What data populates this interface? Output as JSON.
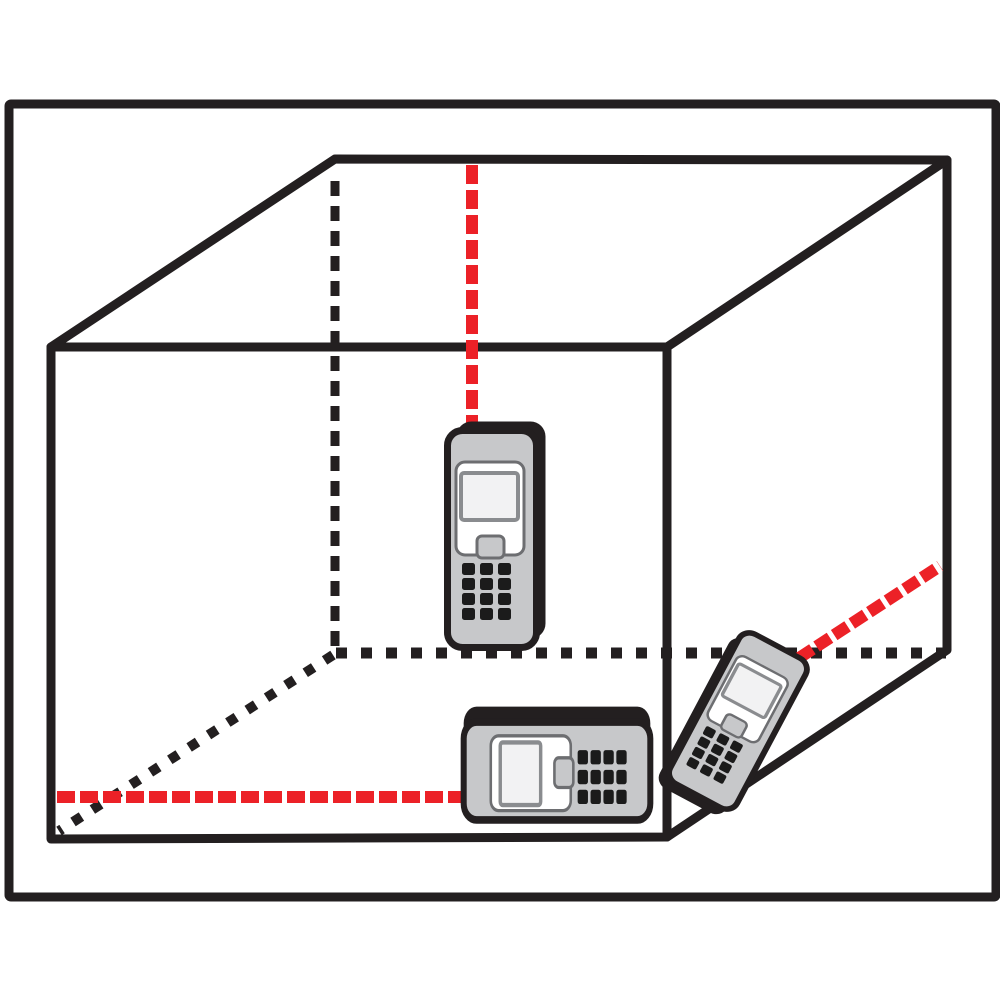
{
  "colors": {
    "background": "#FFFFFF",
    "line": "#231F20",
    "laser_red": "#EC2127",
    "device_body": "#C7C8CA",
    "panel_fill": "#FFFFFF",
    "panel_border": "#6D6E71",
    "screen_fill": "#F2F2F3",
    "screen_border": "#8A8C8F",
    "key": "#1B1B1B"
  },
  "diagram": {
    "frame": {
      "x": 9,
      "y": 104,
      "w": 987,
      "h": 793,
      "stroke_w": 9
    },
    "room": {
      "stroke_w": 9,
      "silhouette_path": "M 51 839 L 51 347 L 335 159 L 947 160 L 947 650 L 667 837 Z",
      "interior_path": "M 51 347 L 667 347 L 947 160 M 667 347 L 667 837",
      "hidden_edges": [
        {
          "name": "hidden-edge-back-left-vertical",
          "x1": 335,
          "y1": 181,
          "x2": 335,
          "y2": 651,
          "w": 9,
          "dash": "15 10"
        },
        {
          "name": "hidden-edge-back-bottom",
          "x1": 336,
          "y1": 653,
          "x2": 946,
          "y2": 653,
          "w": 11,
          "dash": "11 14"
        },
        {
          "name": "hidden-edge-floor-left",
          "x1": 333,
          "y1": 655,
          "x2": 59,
          "y2": 831,
          "w": 10,
          "dash": "10 13"
        }
      ]
    },
    "lasers": [
      {
        "name": "laser-beam-height",
        "x1": 472,
        "y1": 165,
        "x2": 472,
        "y2": 428,
        "w": 12,
        "dash": "19 6"
      },
      {
        "name": "laser-beam-length",
        "x1": 57,
        "y1": 797,
        "x2": 463,
        "y2": 797,
        "w": 12,
        "dash": "18 5"
      },
      {
        "name": "laser-beam-width",
        "x1": 799,
        "y1": 658,
        "x2": 940,
        "y2": 566,
        "w": 12,
        "dash": "16 5"
      }
    ],
    "device_design": {
      "body": {
        "x": -44.5,
        "y": -108.5,
        "w": 89,
        "h": 217,
        "rx": 15,
        "stroke_w": 7
      },
      "panel": {
        "x": -36,
        "y": -77,
        "w": 68,
        "h": 93,
        "rx": 9,
        "stroke_w": 3
      },
      "screen": {
        "x": -31,
        "y": -66,
        "w": 57,
        "h": 47,
        "rx": 3,
        "stroke_w": 4
      },
      "notch": {
        "x": -15,
        "y": -3,
        "w": 27,
        "h": 22,
        "rx": 5,
        "stroke_w": 3
      },
      "keys": {
        "cols": [
          -30,
          -12,
          6
        ],
        "rows": [
          24,
          39,
          54,
          69
        ],
        "w": 13,
        "h": 12,
        "rx": 2.5
      }
    },
    "devices": [
      {
        "name": "laser-meter-vertical",
        "transform": "translate(492,539)",
        "depth": [
          9,
          -9
        ]
      },
      {
        "name": "laser-meter-horizontal",
        "transform": "translate(557,771) rotate(-90) scale(1.1,0.86)",
        "depth": [
          14,
          0
        ]
      },
      {
        "name": "laser-meter-tilted",
        "transform": "translate(738,721) rotate(28) scale(0.85,0.78)",
        "depth": [
          -8,
          12
        ]
      }
    ]
  }
}
